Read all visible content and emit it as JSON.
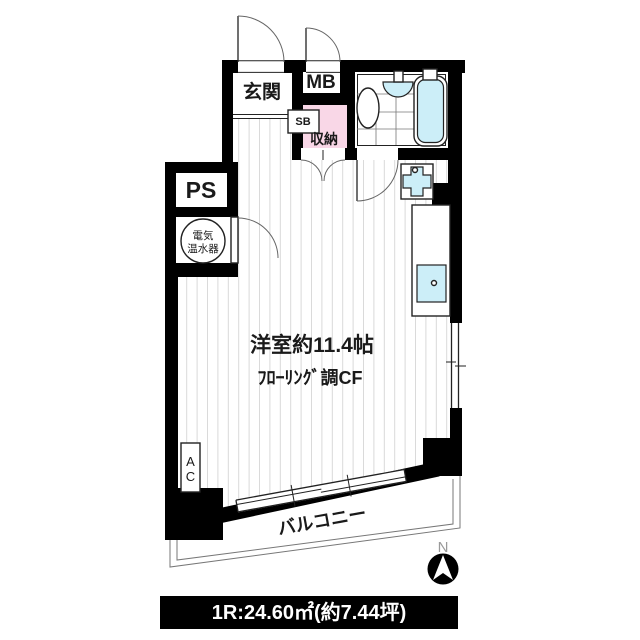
{
  "plan": {
    "rooms": {
      "entrance": "玄関",
      "meter_box": "MB",
      "shoe_box": "SB",
      "storage": "収納",
      "pipe_space": "PS",
      "water_heater_line1": "電気",
      "water_heater_line2": "温水器",
      "main_room_size": "洋室約11.4帖",
      "main_room_floor": "ﾌﾛｰﾘﾝｸﾞ調CF",
      "ac_line1": "A",
      "ac_line2": "C",
      "balcony": "バルコニー"
    },
    "compass": {
      "north": "N"
    },
    "footer": {
      "text": "1R:24.60㎡(約7.44坪)"
    },
    "colors": {
      "wall": "#000000",
      "accent_pink": "#f9d7e7",
      "accent_aqua": "#cceef8",
      "stripe": "#d9d9d9",
      "outline_gray": "#888888",
      "north_gray": "#9a9a9a"
    }
  }
}
